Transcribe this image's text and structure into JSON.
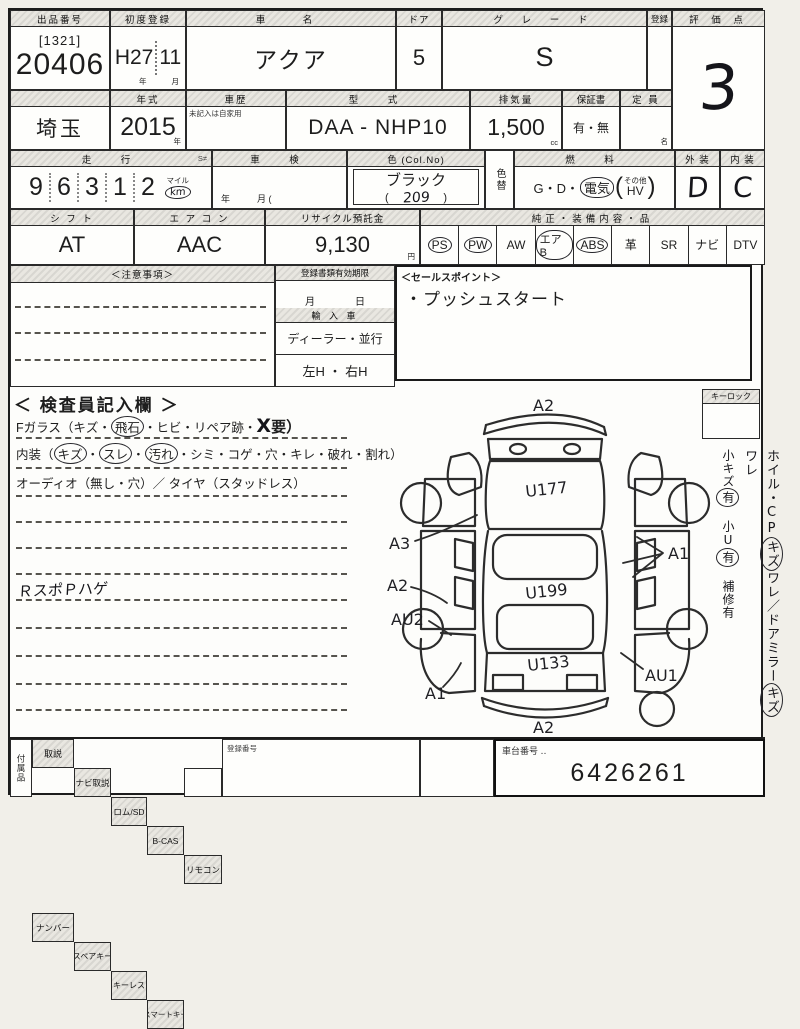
{
  "row1": {
    "lot_label": "出品番号",
    "lot_code": "[1321]",
    "lot_number": "20406",
    "first_reg_label": "初度登録",
    "first_reg_era": "H27",
    "first_reg_month": "11",
    "unit_year": "年",
    "unit_month": "月",
    "car_name_label": "車　名",
    "car_name": "アクア",
    "door_label": "ドア",
    "door_value": "5",
    "grade_label": "グ レ ー ド",
    "grade_value": "S",
    "small_col_label": "登録",
    "score_label": "評 価 点",
    "score_value": "3"
  },
  "row2": {
    "prefecture": "埼玉",
    "year_label": "年式",
    "year_value": "2015",
    "unit_year": "年",
    "history_label": "車歴",
    "history_note": "未記入は自家用",
    "model_label": "型　式",
    "model_value": "DAA - NHP10",
    "displacement_label": "排気量",
    "displacement_value": "1,500",
    "unit_cc": "cc",
    "warranty_label": "保証書",
    "warranty_value": "有・無",
    "capacity_label": "定 員",
    "unit_persons": "名"
  },
  "row3": {
    "mileage_label": "走　行",
    "mileage_flag": "S≠",
    "digits": [
      "9",
      "6",
      "3",
      "1",
      "2"
    ],
    "unit_mile": "マイル",
    "unit_km": "km",
    "shaken_label": "車　検",
    "shaken_units": "年　　　月 (",
    "color_label": "色 (Col.No)",
    "color_value": "ブラック",
    "color_no_open": "(",
    "color_no": "209",
    "color_no_close": ")",
    "color_change_label": "色替",
    "fuel_label": "燃　料",
    "fuel_gd": "G・D・",
    "fuel_denki": "電気",
    "paren_open": "(",
    "fuel_other": "その他",
    "fuel_hv": "HV",
    "paren_close": ")",
    "exterior_label": "外 装",
    "exterior_value": "D",
    "interior_label": "内 装",
    "interior_value": "C"
  },
  "row4": {
    "shift_label": "シ フ ト",
    "shift_value": "AT",
    "aircon_label": "エ ア コ ン",
    "aircon_value": "AAC",
    "recycle_label": "リサイクル預託金",
    "recycle_value": "9,130",
    "unit_yen": "円",
    "equip_label": "純正・装備内容・品",
    "equipment": [
      {
        "label": "PS",
        "circled": true
      },
      {
        "label": "PW",
        "circled": true
      },
      {
        "label": "AW",
        "circled": false
      },
      {
        "label": "エアB",
        "circled": true
      },
      {
        "label": "ABS",
        "circled": true
      },
      {
        "label": "革",
        "circled": false
      },
      {
        "label": "SR",
        "circled": false
      },
      {
        "label": "ナビ",
        "circled": false
      },
      {
        "label": "DTV",
        "circled": false
      }
    ]
  },
  "row5": {
    "notes_label": "＜注意事項＞",
    "docs_label": "登録書類有効期限",
    "docs_units": "月　　　　日",
    "import_label": "輸 入 車",
    "import_dealer": "ディーラー・並行",
    "import_handle": "左H ・ 右H",
    "sales_label": "＜セールスポイント＞",
    "sales_point": "・プッシュスタート"
  },
  "inspector": {
    "title": "＜ 検査員記入欄 ＞",
    "line1_pre": "Fガラス（キズ・",
    "line1_circled": "飛石",
    "line1_mid": "・ヒビ・リペア跡・",
    "line1_x": "X",
    "line1_post": "要）",
    "line2_pre": "内装（",
    "line2_c1": "キズ",
    "line2_d1": "・",
    "line2_c2": "スレ",
    "line2_d2": "・",
    "line2_c3": "汚れ",
    "line2_post": "・シミ・コゲ・穴・キレ・破れ・割れ）",
    "line3": "オーディオ（無し・穴）／ タイヤ（スタッドレス）",
    "memo": "ＲスポＰハゲ"
  },
  "diagram": {
    "keylock_label": "キーロック",
    "annotations": {
      "top": "A2",
      "hood": "U177",
      "left1": "A3",
      "left2": "A2",
      "left3": "AU2",
      "roof": "U199",
      "right1": "A1",
      "rear_glass": "U133",
      "bottom_left": "A1",
      "right2": "AU1",
      "bottom": "A2"
    }
  },
  "side_notes": {
    "l1a": "ホイル・CP",
    "l1c1": "キズ",
    "l1b": "ワレ／ドアミラー",
    "l1c2": "キズ",
    "l1c": "ワレ",
    "l2a": "小キズ",
    "l2c1": "有",
    "l2b": "　小U",
    "l2c2": "有",
    "l2c": "　補修有"
  },
  "bottom": {
    "accessories_label": "付属品",
    "headers": [
      "取説",
      "ナビ取説",
      "ロム/SD",
      "B-CAS",
      "リモコン"
    ],
    "row2": [
      "ナンバー",
      "スペアキー",
      "キーレス",
      "スマートキー"
    ],
    "regno_label": "登録番号",
    "chassis_label": "車台番号 ‥",
    "chassis_value": "6426261"
  }
}
